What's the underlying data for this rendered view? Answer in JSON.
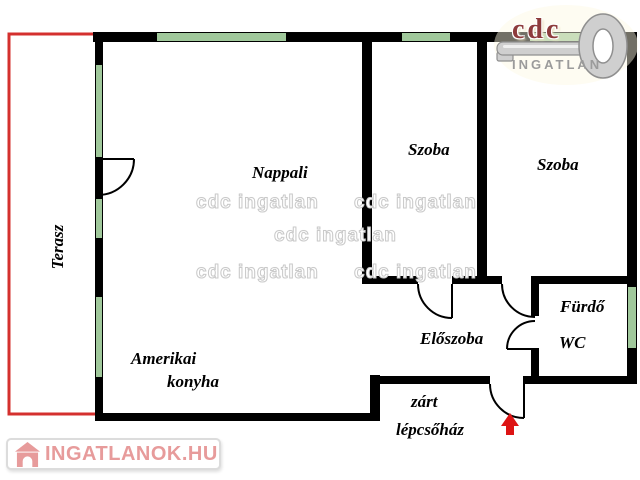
{
  "colors": {
    "wall": "#000000",
    "window": "#a0c89b",
    "terrace": "#d4302e",
    "arrow": "#dd1414",
    "brand_red": "#8d3b3b",
    "brand_gray": "#9b9b9b",
    "site_red": "#e79b9b",
    "wm_stroke": "#c9c9c9"
  },
  "watermark_text": "cdc ingatlan",
  "brand": {
    "name": "cdc",
    "tagline": "INGATLAN"
  },
  "site": {
    "name": "INGATLANOK.HU"
  },
  "labels": {
    "nappali": "Nappali",
    "szoba_top": "Szoba",
    "szoba_right": "Szoba",
    "terasz": "Terasz",
    "kitchen_line1": "Amerikai",
    "kitchen_line2": "konyha",
    "eloszoba": "Előszoba",
    "furdo": "Fürdő",
    "wc": "WC",
    "stairwell_line1": "zárt",
    "stairwell_line2": "lépcsőház"
  }
}
